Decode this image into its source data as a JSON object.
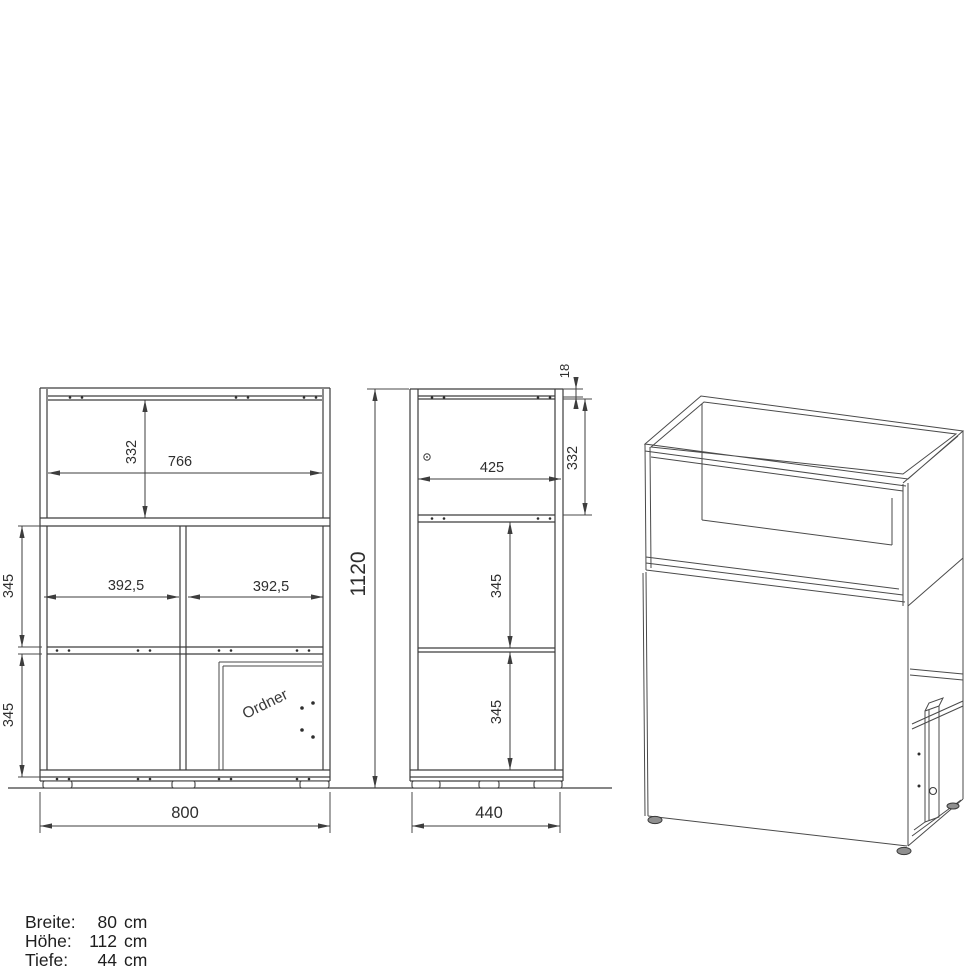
{
  "drawing": {
    "title": "cabinet-dimension-drawing",
    "front": {
      "shelf_height": "332",
      "shelf_width": "766",
      "row1_height": "345",
      "bay_left": "392,5",
      "bay_right": "392,5",
      "row2_height": "345",
      "total_width": "800",
      "binder_label": "Ordner"
    },
    "side": {
      "panel_thickness": "18",
      "top_height": "332",
      "depth_inner": "425",
      "row1_height": "345",
      "row2_height": "345",
      "total_height": "1120",
      "total_depth": "440"
    }
  },
  "specs": {
    "rows": [
      {
        "label": "Breite:",
        "value": "80",
        "unit": "cm"
      },
      {
        "label": "Höhe:",
        "value": "112",
        "unit": "cm"
      },
      {
        "label": "Tiefe:",
        "value": "44",
        "unit": "cm"
      }
    ]
  },
  "colors": {
    "line": "#3d3d3d",
    "text": "#2e2e2e",
    "background": "#ffffff"
  }
}
